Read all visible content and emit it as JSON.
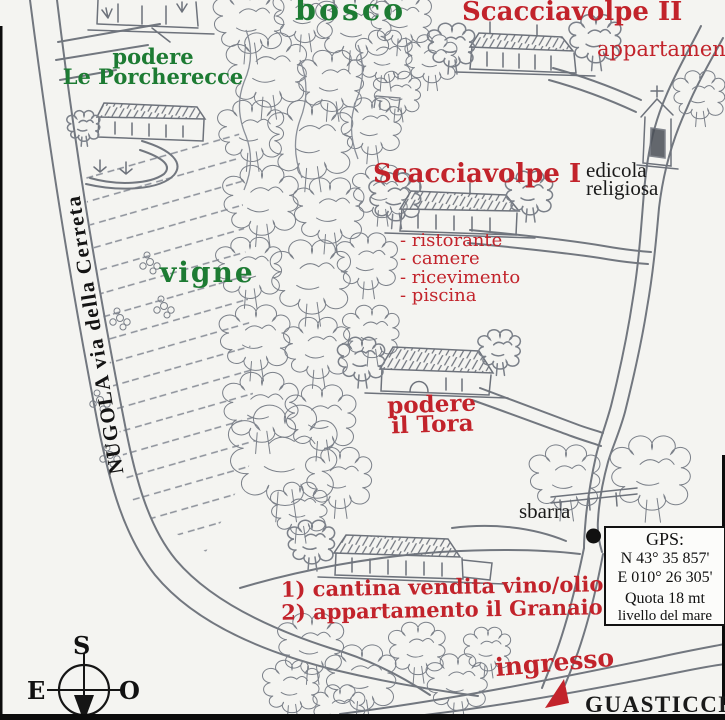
{
  "map": {
    "region_labels": {
      "bosco": "bosco",
      "vigne": "vigne",
      "road": "NUGOLA via della Cerreta",
      "town": "GUASTICCE"
    },
    "places": {
      "porcherecce_line1": "podere",
      "porcherecce_line2": "Le Porcherecce",
      "scacciavolpe2": "Scacciavolpe II",
      "scacciavolpe2_sub": "appartamenti",
      "scacciavolpe1": "Scacciavolpe I",
      "edicola_line1": "edicola",
      "edicola_line2": "religiosa",
      "tora_line1": "podere",
      "tora_line2": "il Tora",
      "sbarra": "sbarra",
      "ingresso": "ingresso"
    },
    "services": [
      "- ristorante",
      "- camere",
      "- ricevimento",
      "- piscina"
    ],
    "notes": [
      "1) cantina vendita vino/olio",
      "2) appartamento il Granaio"
    ],
    "gps": {
      "title": "GPS:",
      "lat": "N 43° 35 857'",
      "lon": "E 010° 26 305'",
      "quota": "Quota 18 mt",
      "quota2": "livello del mare"
    },
    "compass": {
      "top": "S",
      "left": "E",
      "right": "O"
    },
    "colors": {
      "red": "#c2232b",
      "green": "#1d7b33",
      "pencil": "#72777f",
      "ink": "#1a1a1a"
    }
  }
}
